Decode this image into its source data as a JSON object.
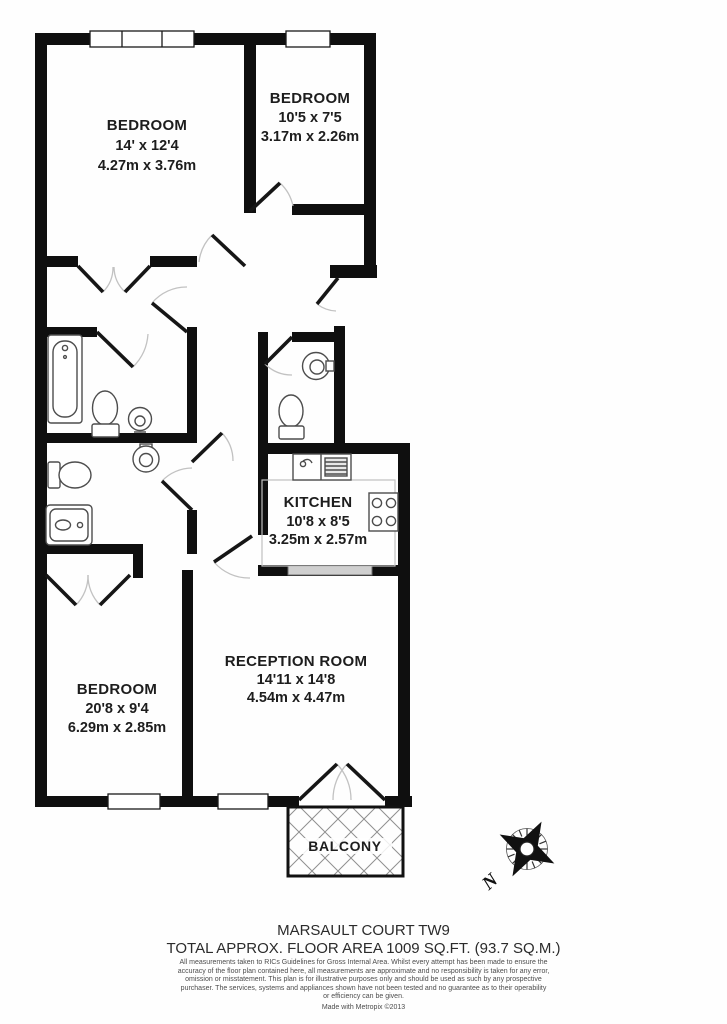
{
  "plan": {
    "rooms": [
      {
        "name": "BEDROOM",
        "imperial": "14' x 12'4",
        "metric": "4.27m x 3.76m"
      },
      {
        "name": "BEDROOM",
        "imperial": "10'5 x 7'5",
        "metric": "3.17m x 2.26m"
      },
      {
        "name": "KITCHEN",
        "imperial": "10'8 x 8'5",
        "metric": "3.25m x 2.57m"
      },
      {
        "name": "BEDROOM",
        "imperial": "20'8 x 9'4",
        "metric": "6.29m x 2.85m"
      },
      {
        "name": "RECEPTION ROOM",
        "imperial": "14'11 x 14'8",
        "metric": "4.54m x 4.47m"
      }
    ],
    "balcony_label": "BALCONY",
    "compass": {
      "north_label": "N"
    },
    "colors": {
      "wall": "#0f0f0f",
      "room_fill": "#ffffff",
      "door_arc": "#c2c2c2",
      "fixture_stroke": "#4d4d4d",
      "counter": "#c0c0c0",
      "hatch_fill": "#cfcfcf"
    }
  },
  "footer": {
    "title": "MARSAULT COURT TW9",
    "area_line": "TOTAL APPROX. FLOOR AREA 1009 SQ.FT. (93.7 SQ.M.)",
    "disclaimer": "All measurements taken to RICs Guidelines for Gross Internal Area. Whilst every attempt has been made to ensure the accuracy of the floor plan contained here, all measurements are approximate and no responsibility is taken for any error, omission or misstatement. This plan is for illustrative purposes only and should be used as such by any prospective purchaser. The services, systems and appliances shown have not been tested and no guarantee as to their operability or efficiency can be given.",
    "credit": "Made with Metropix ©2013"
  }
}
